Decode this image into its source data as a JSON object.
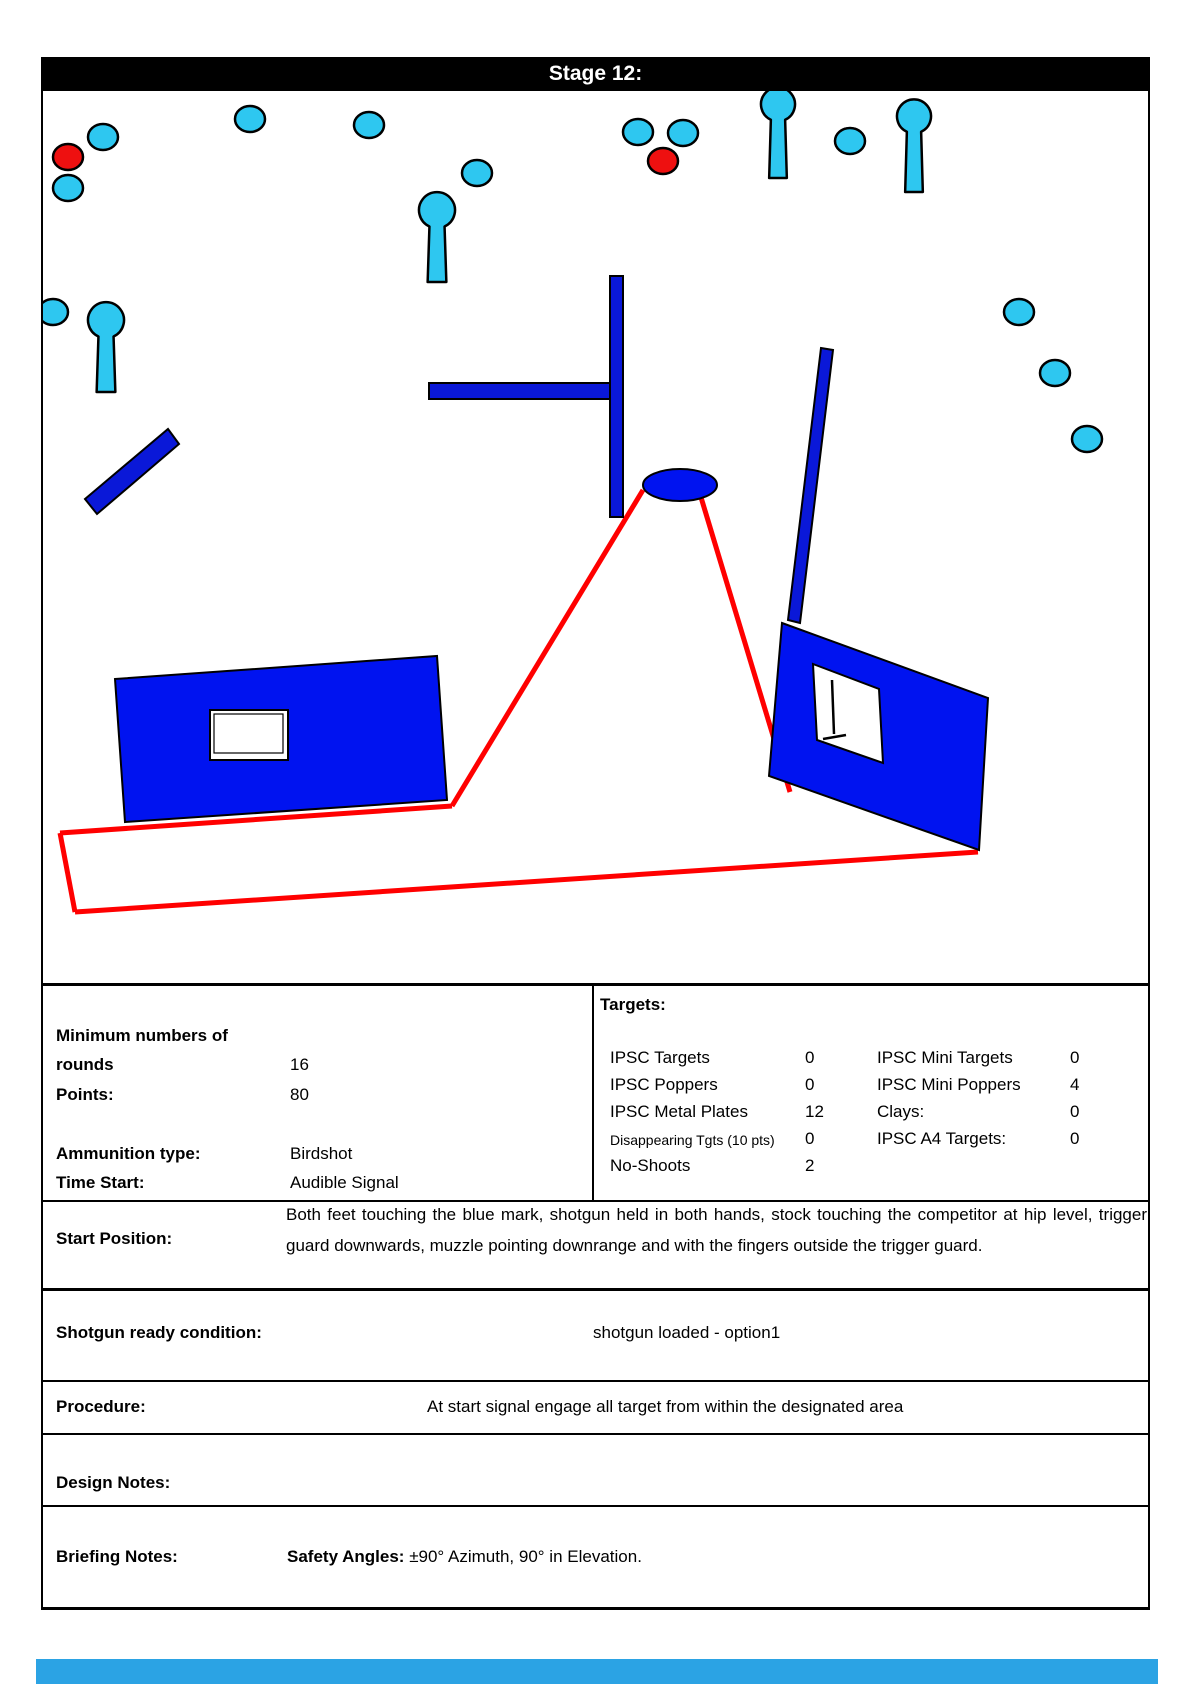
{
  "header": {
    "title": "Stage 12:"
  },
  "info": {
    "min_rounds_label_line1": "Minimum numbers of",
    "min_rounds_label_line2": "rounds",
    "min_rounds_value": "16",
    "points_label": "Points:",
    "points_value": "80",
    "ammo_label": "Ammunition type:",
    "ammo_value": "Birdshot",
    "time_label": "Time Start:",
    "time_value": "Audible Signal"
  },
  "targets": {
    "title": "Targets:",
    "col1": [
      {
        "label": "IPSC Targets",
        "value": "0",
        "small": false
      },
      {
        "label": "IPSC Poppers",
        "value": "0",
        "small": false
      },
      {
        "label": "IPSC Metal Plates",
        "value": "12",
        "small": false
      },
      {
        "label": "Disappearing Tgts (10 pts)",
        "value": "0",
        "small": true
      },
      {
        "label": "No-Shoots",
        "value": "2",
        "small": false
      }
    ],
    "col2": [
      {
        "label": "IPSC Mini Targets",
        "value": "0",
        "small": false
      },
      {
        "label": "IPSC Mini Poppers",
        "value": "4",
        "small": false
      },
      {
        "label": "Clays:",
        "value": "0",
        "small": false
      },
      {
        "label": "IPSC A4 Targets:",
        "value": "0",
        "small": false
      }
    ]
  },
  "rows": {
    "start_position_label": "Start Position:",
    "start_position_text": "Both feet touching the blue mark, shotgun held in both hands, stock touching the competitor at hip level, trigger guard  downwards, muzzle pointing downrange and with the fingers outside the trigger guard.",
    "ready_label": "Shotgun ready condition:",
    "ready_value": "shotgun loaded - option1",
    "procedure_label": "Procedure:",
    "procedure_value": "At start signal engage all target from within the designated area",
    "design_label": "Design Notes:",
    "briefing_label": "Briefing Notes:",
    "briefing_bold": "Safety Angles:",
    "briefing_text": " ±90° Azimuth, 90° in Elevation."
  },
  "diagram": {
    "colors": {
      "plate_cyan": "#2EC7F0",
      "no_shoot_red": "#EE1010",
      "wall_blue": "#0013F0",
      "bar_blue": "#0A18D8",
      "fault_red": "#FF0000",
      "outline": "#000000",
      "window_white": "#FFFFFF"
    },
    "fault_lines": [
      [
        60,
        833,
        452,
        806
      ],
      [
        452,
        806,
        643,
        490
      ],
      [
        700,
        494,
        790,
        792
      ],
      [
        60,
        833,
        75,
        912
      ],
      [
        75,
        912,
        978,
        852
      ]
    ],
    "bars": [
      [
        [
          429,
          383
        ],
        [
          611,
          383
        ],
        [
          611,
          399
        ],
        [
          429,
          399
        ]
      ],
      [
        [
          610,
          276
        ],
        [
          623,
          276
        ],
        [
          623,
          517
        ],
        [
          610,
          517
        ]
      ],
      [
        [
          85,
          499
        ],
        [
          168,
          429
        ],
        [
          179,
          444
        ],
        [
          97,
          514
        ]
      ],
      [
        [
          821,
          348
        ],
        [
          833,
          350
        ],
        [
          800,
          623
        ],
        [
          788,
          620
        ]
      ]
    ],
    "walls": [
      [
        [
          115,
          679
        ],
        [
          437,
          656
        ],
        [
          447,
          800
        ],
        [
          125,
          822
        ]
      ],
      [
        [
          782,
          623
        ],
        [
          988,
          698
        ],
        [
          979,
          850
        ],
        [
          769,
          776
        ]
      ]
    ],
    "left_window": {
      "outer": [
        210,
        710,
        78,
        50
      ],
      "inner": [
        214,
        714,
        69,
        39
      ]
    },
    "right_window": {
      "poly": [
        [
          813,
          664
        ],
        [
          879,
          689
        ],
        [
          883,
          763
        ],
        [
          817,
          740
        ]
      ],
      "stand": [
        [
          832,
          680,
          834,
          734
        ],
        [
          823,
          739,
          846,
          735
        ]
      ]
    },
    "start_mark": {
      "cx": 680,
      "cy": 485,
      "rx": 37,
      "ry": 16
    },
    "poppers": [
      [
        437,
        213,
        18,
        282
      ],
      [
        106,
        323,
        18,
        392
      ],
      [
        778,
        107,
        17,
        178
      ],
      [
        914,
        119,
        17,
        192
      ]
    ],
    "plates": [
      [
        103,
        137
      ],
      [
        68,
        188
      ],
      [
        250,
        119
      ],
      [
        369,
        125
      ],
      [
        477,
        173
      ],
      [
        638,
        132
      ],
      [
        683,
        133
      ],
      [
        850,
        141
      ],
      [
        53,
        312
      ],
      [
        1019,
        312
      ],
      [
        1055,
        373
      ],
      [
        1087,
        439
      ]
    ],
    "no_shoots": [
      [
        68,
        157
      ],
      [
        663,
        161
      ]
    ],
    "plate_rx": 15,
    "plate_ry": 13,
    "bottom_strip_color": "#2BA3E4"
  }
}
